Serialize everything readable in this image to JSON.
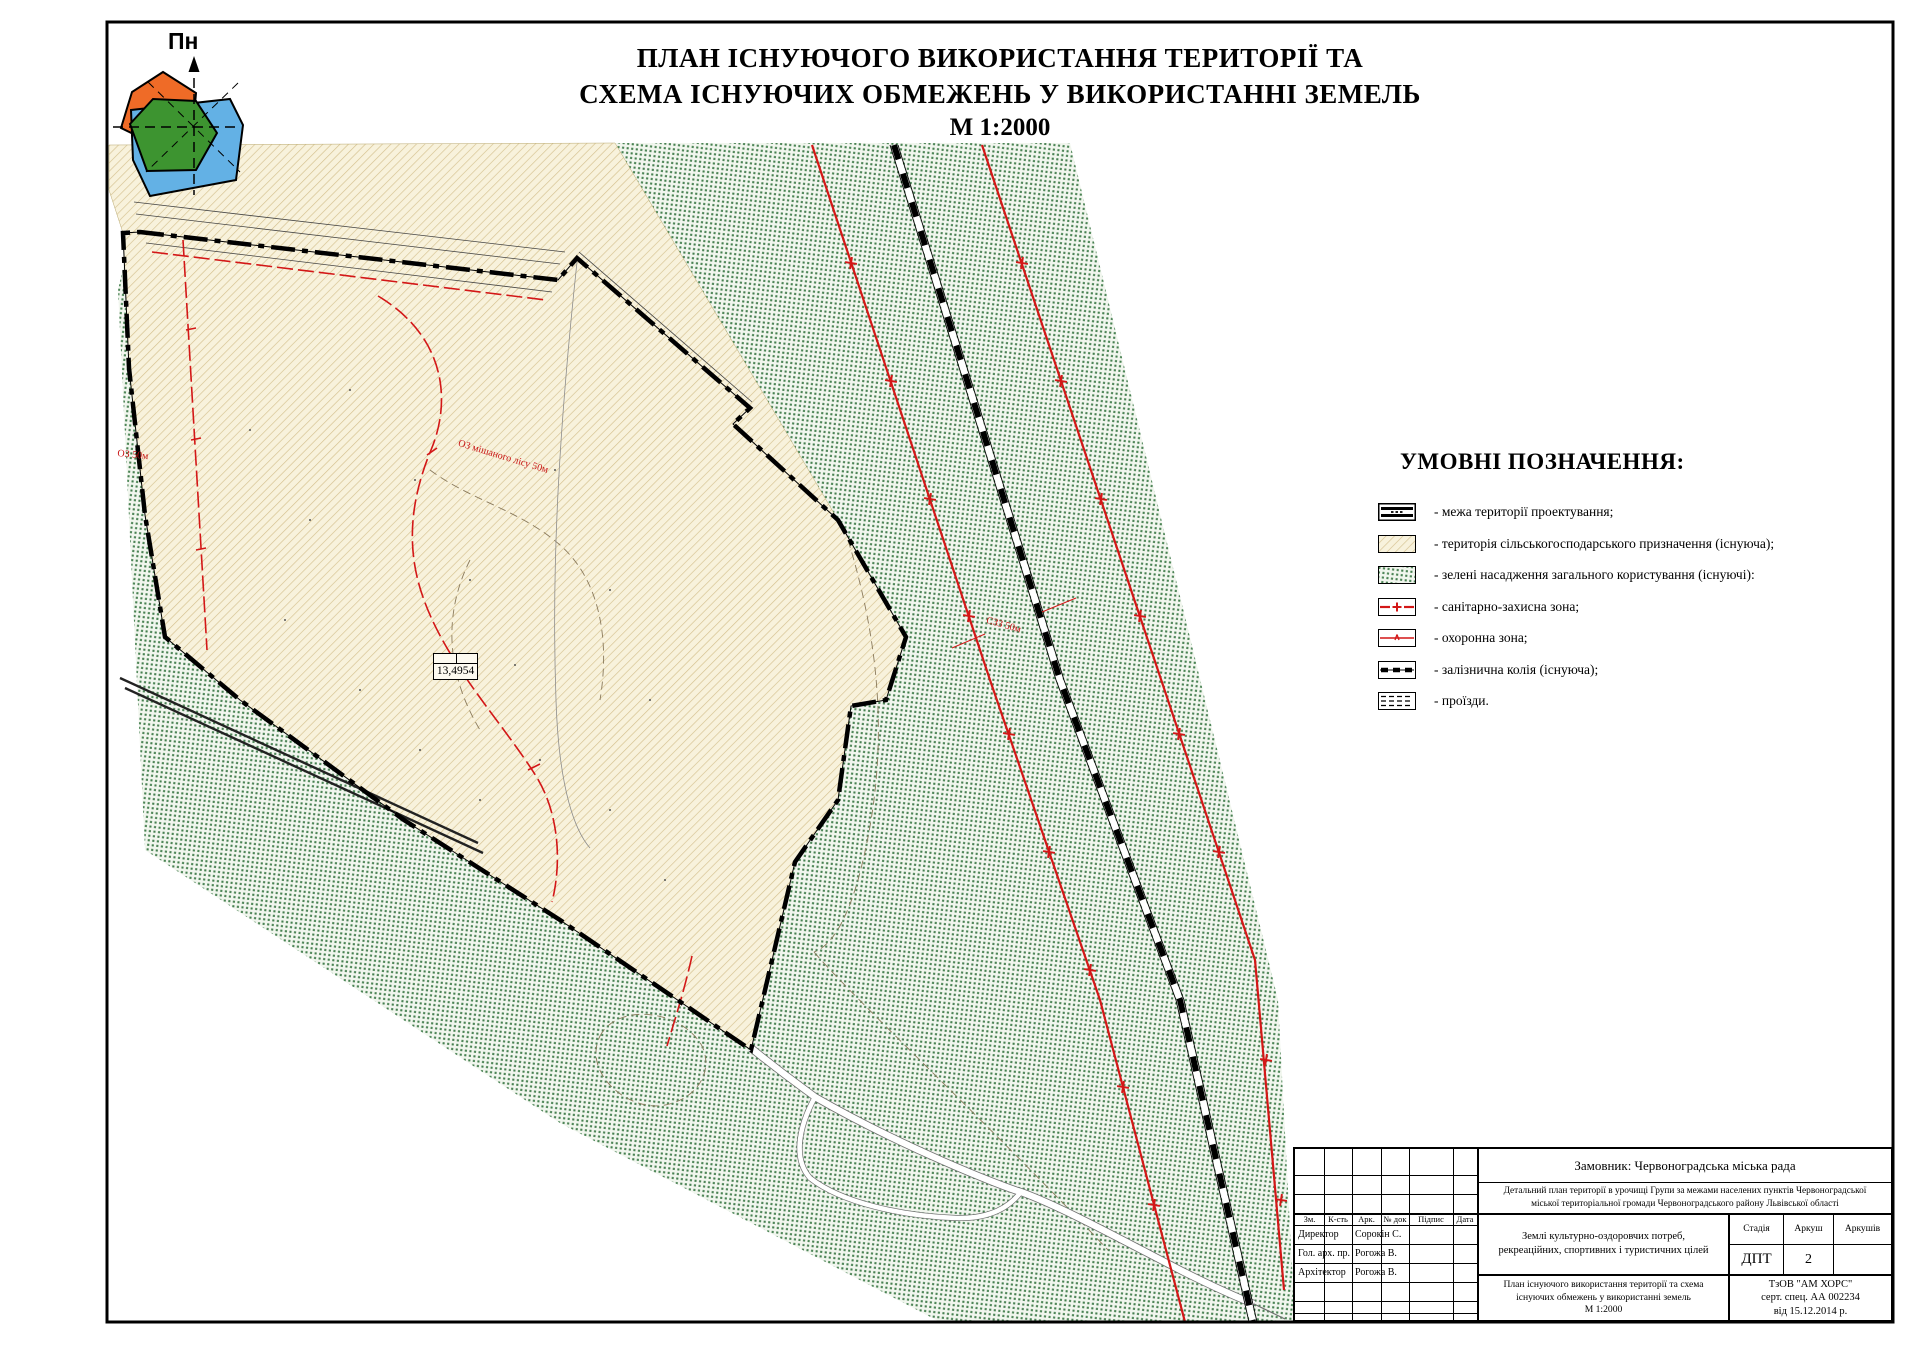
{
  "title": {
    "line1": "ПЛАН ІСНУЮЧОГО ВИКОРИСТАННЯ ТЕРИТОРІЇ  ТА",
    "line2": "СХЕМА ІСНУЮЧИХ ОБМЕЖЕНЬ У ВИКОРИСТАННІ ЗЕМЕЛЬ",
    "line3": "М 1:2000"
  },
  "compass": {
    "north_label": "Пн"
  },
  "legend": {
    "heading": "УМОВНІ ПОЗНАЧЕННЯ:",
    "items": [
      {
        "label": "- межа території проектування;"
      },
      {
        "label": "- територія сільськогосподарського призначення (існуюча);"
      },
      {
        "label": "- зелені насадження загального користування (існуючі):"
      },
      {
        "label": "- санітарно-захисна зона;"
      },
      {
        "label": "- охоронна зона;"
      },
      {
        "label": "- залізнична колія (існуюча);"
      },
      {
        "label": "- проїзди."
      }
    ]
  },
  "map_labels": {
    "area_value": "13,4954",
    "oz_left": "ОЗ 50м",
    "oz_forest": "ОЗ мішаного лісу 50м",
    "szz": "СЗЗ 50м"
  },
  "title_block": {
    "customer": "Замовник: Червоноградська міська рада",
    "project_line1": "Детальний план території в урочищі Групи за межами населених пунктів Червоноградської",
    "project_line2": "міської територіальної громади Червоноградського району Львівської області",
    "land_use_line1": "Землі культурно-оздоровчих потреб,",
    "land_use_line2": "рекреаційних, спортивних і туристичних цілей",
    "sheet_title_line1": "План існуючого використання території та схема",
    "sheet_title_line2": "існуючих обмежень у використанні земель",
    "sheet_title_line3": "М 1:2000",
    "stage_label": "Стадія",
    "sheet_label": "Аркуш",
    "sheets_label": "Аркушів",
    "stage_value": "ДПТ",
    "sheet_value": "2",
    "sheets_value": "",
    "org_line1": "ТзОВ \"АМ ХОРС\"",
    "org_line2": "серт. спец. АА 002234",
    "org_line3": "від 15.12.2014 р.",
    "table_headers": [
      "Зм.",
      "К-сть",
      "Арк.",
      "№ док",
      "Підпис",
      "Дата"
    ],
    "signers": [
      {
        "role": "Директор",
        "name": "Сорокін С."
      },
      {
        "role": "Гол. арх. пр.",
        "name": "Рогожа В."
      },
      {
        "role": "Архітектор",
        "name": "Рогожа В."
      }
    ]
  },
  "colors": {
    "accent_red": "#d31717",
    "agri_beige": "#f8f2dc",
    "hatch_line": "#d4c08e",
    "green_dot": "#468050",
    "compass_orange": "#ef6b27",
    "compass_green": "#3d9430",
    "compass_blue": "#63b1e5"
  }
}
